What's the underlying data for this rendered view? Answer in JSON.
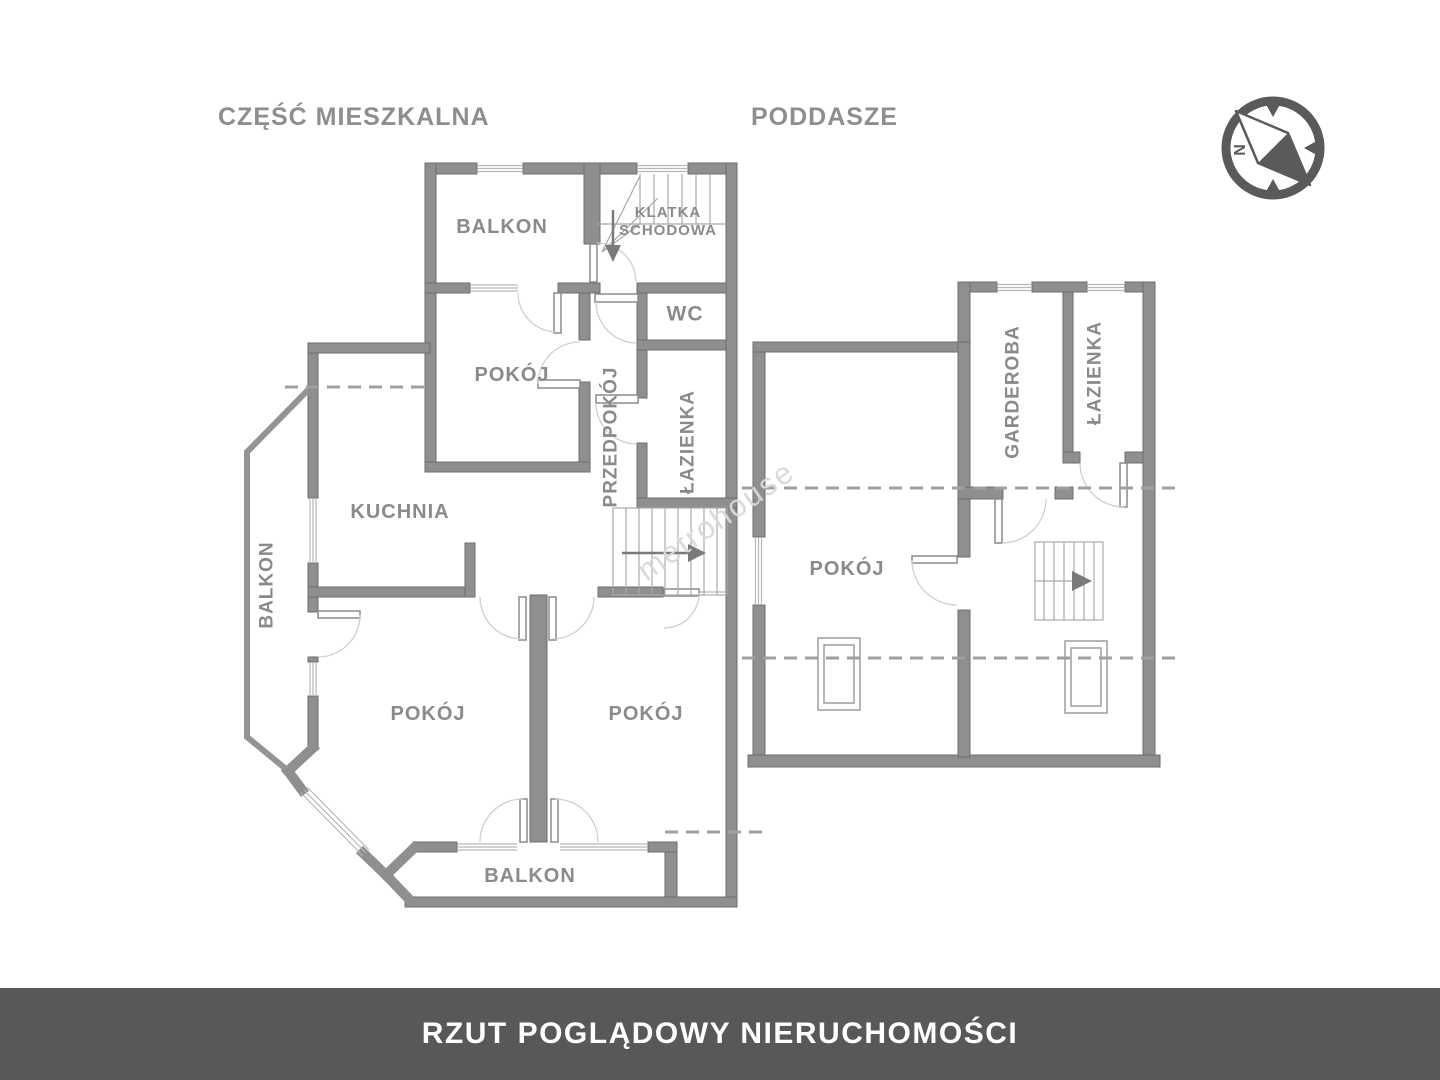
{
  "headers": {
    "left_section": "CZĘŚĆ MIESZKALNA",
    "right_section": "PODDASZE"
  },
  "compass": {
    "north_label": "N"
  },
  "watermark": {
    "text": "metrohouse"
  },
  "footer": {
    "title": "RZUT POGLĄDOWY NIERUCHOMOŚCI",
    "background": "#58585a",
    "text_color": "#ffffff"
  },
  "colors": {
    "wall_fill": "#8f8f8f",
    "wall_outline": "#6e6e6e",
    "label": "#8a8a8a",
    "thin_line": "#b7b7b7",
    "arc": "#cfcfcf",
    "dashed": "#9f9f9f",
    "arrow": "#7a7a7a",
    "compass": "#5a5a5a",
    "watermark": "#d9d9d9"
  },
  "rooms": {
    "balkon_top": "BALKON",
    "klatka": "KLATKA\nSCHODOWA",
    "wc": "WC",
    "pokoj_top": "POKÓJ",
    "przedpokoj": "PRZEDPOKÓJ",
    "lazienka": "ŁAZIENKA",
    "kuchnia": "KUCHNIA",
    "balkon_left": "BALKON",
    "pokoj_bl": "POKÓJ",
    "pokoj_br": "POKÓJ",
    "balkon_bottom": "BALKON",
    "pokoj_attic": "POKÓJ",
    "garderoba": "GARDEROBA",
    "lazienka_attic": "ŁAZIENKA"
  }
}
